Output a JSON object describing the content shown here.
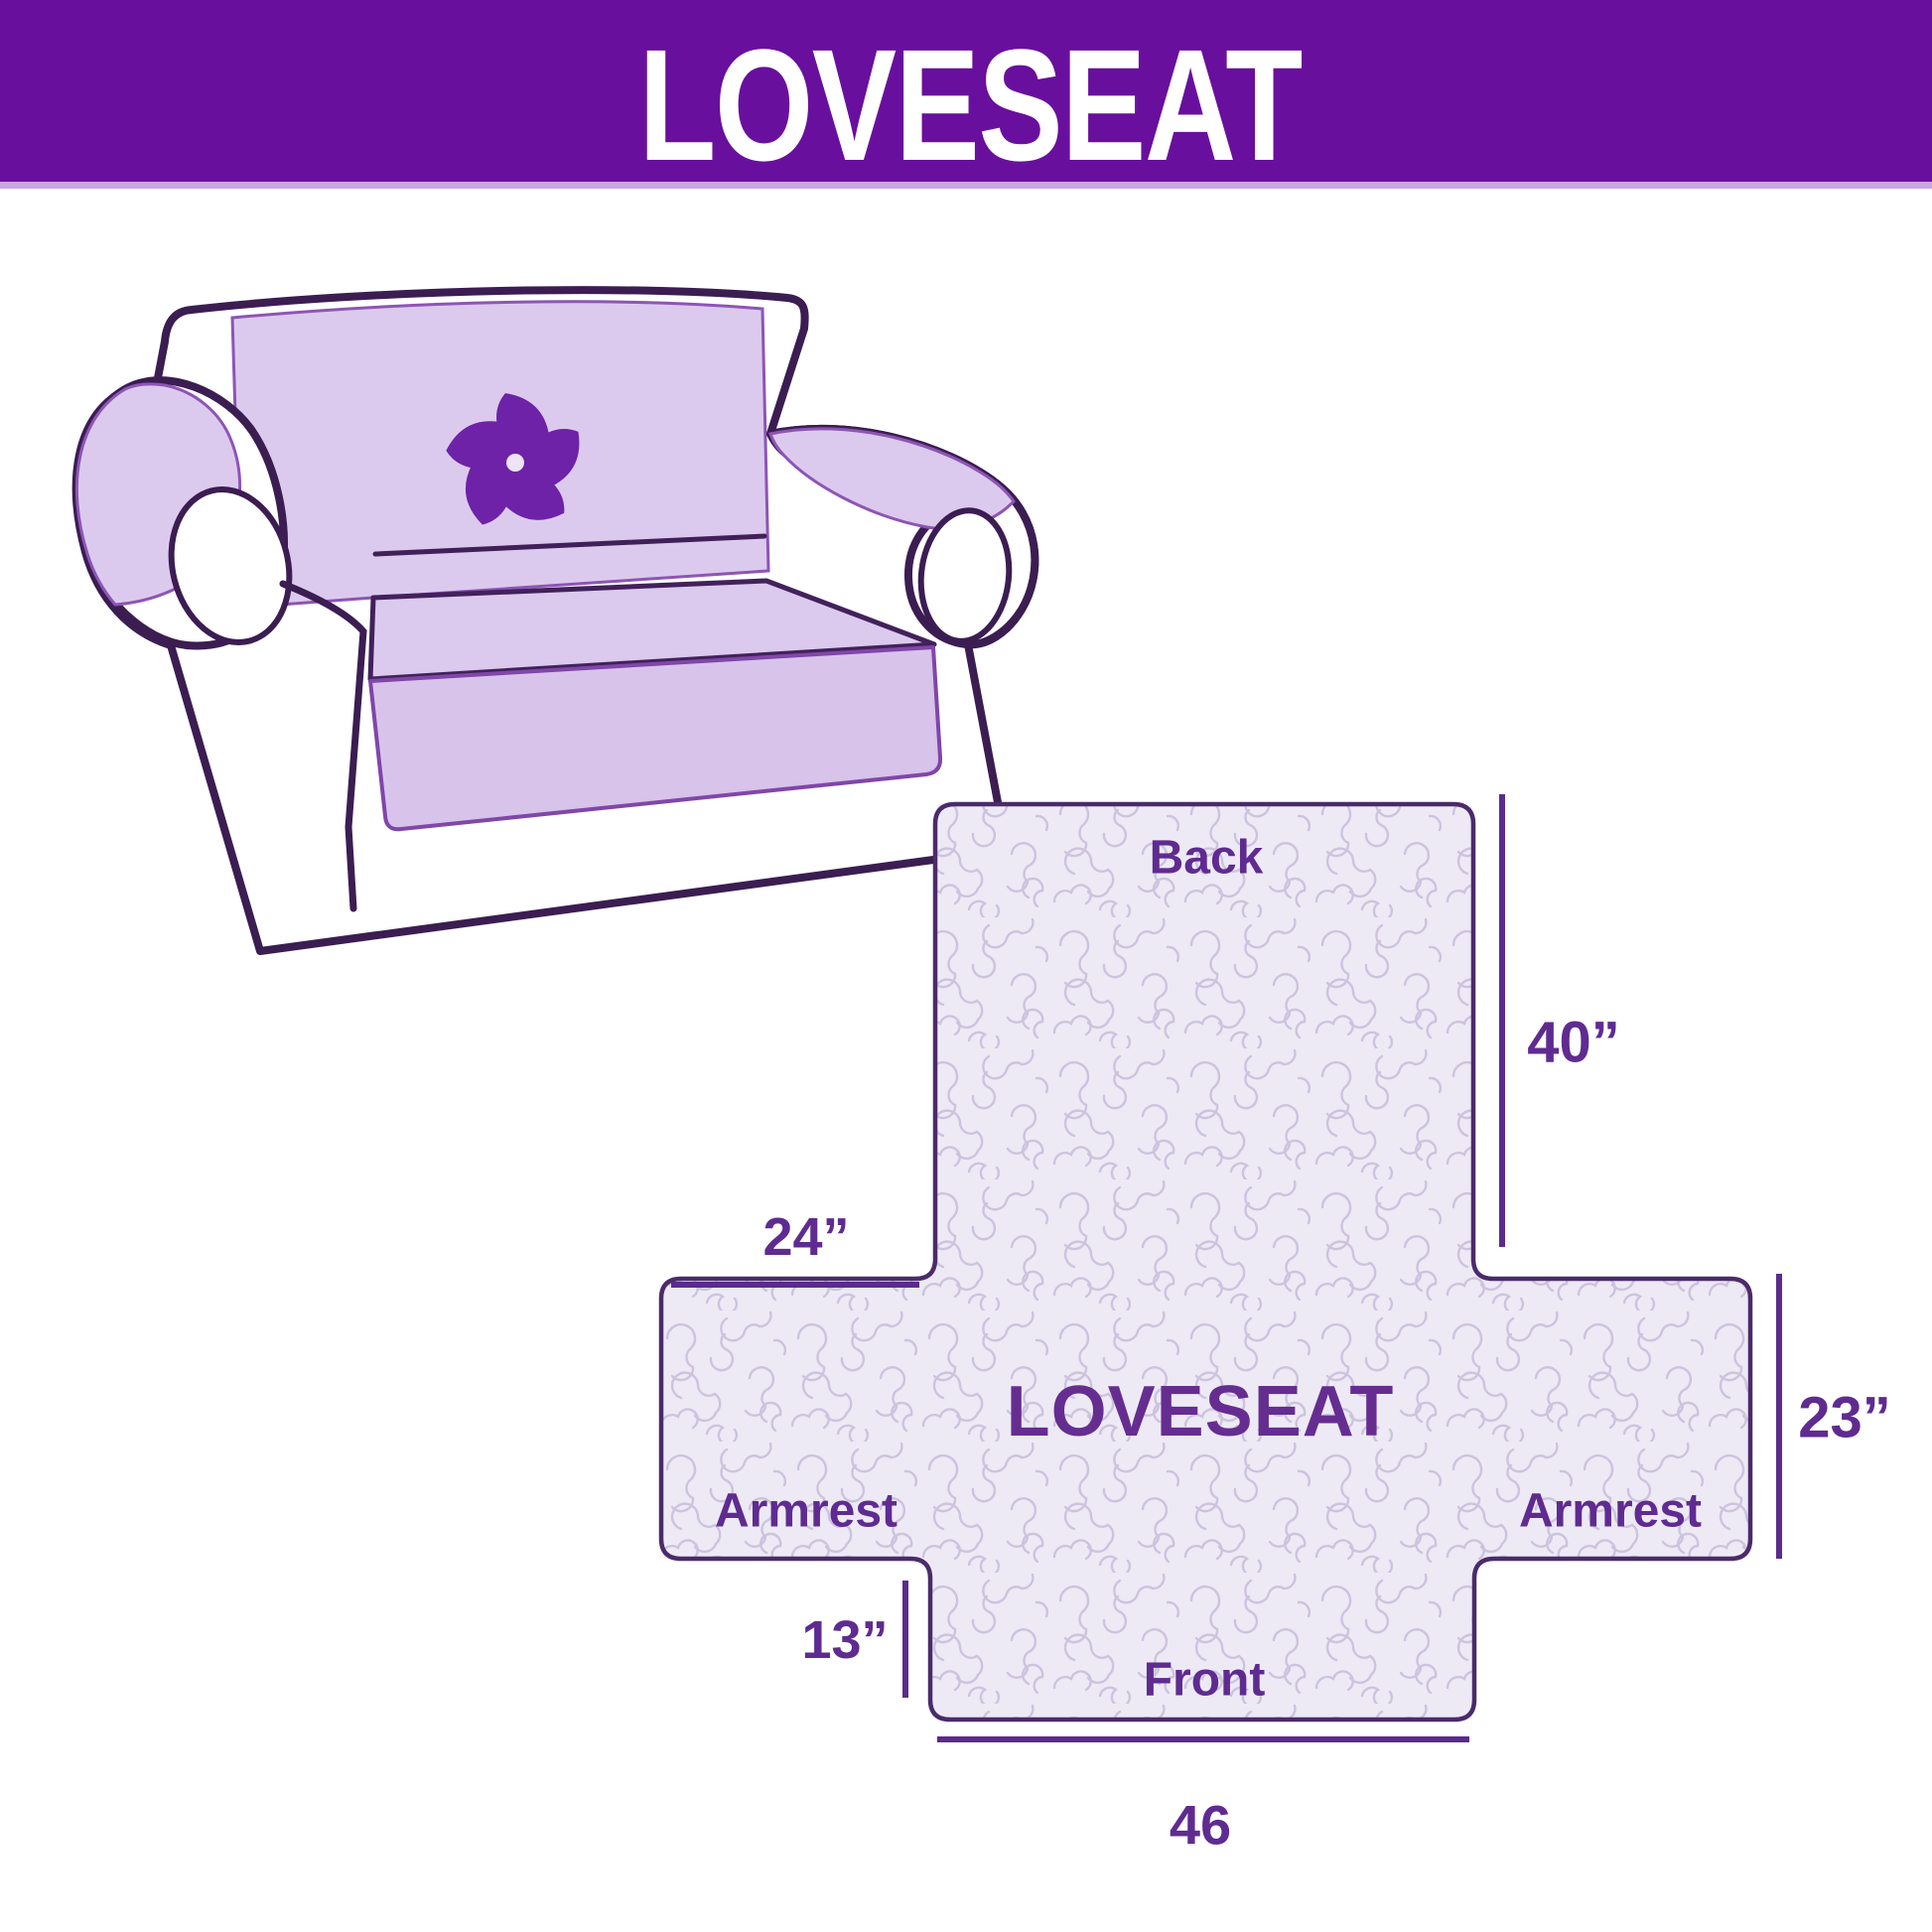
{
  "banner": {
    "title": "LOVESEAT"
  },
  "sofa": {
    "logo_icon": "pinwheel"
  },
  "diagram": {
    "center_label": "LOVESEAT",
    "sections": {
      "back": "Back",
      "front": "Front",
      "armrest_left": "Armrest",
      "armrest_right": "Armrest"
    },
    "dimensions": {
      "back_height": "40”",
      "armrest_left_width": "24”",
      "armrest_depth": "23”",
      "front_drop": "13”",
      "front_width": "46"
    }
  },
  "colors": {
    "banner_bg": "#690f9d",
    "banner_text": "#ffffff",
    "label_text": "#5f2b90",
    "dimension_line": "#5b2b8e",
    "diagram_outline": "#4b2b6b",
    "diagram_fill": "#edeaf5",
    "quilt_pattern_line": "#cdc3de",
    "cover_lavender": "#dccaee",
    "sofa_outline": "#3b1d52",
    "logo_purple": "#6d22a8"
  }
}
